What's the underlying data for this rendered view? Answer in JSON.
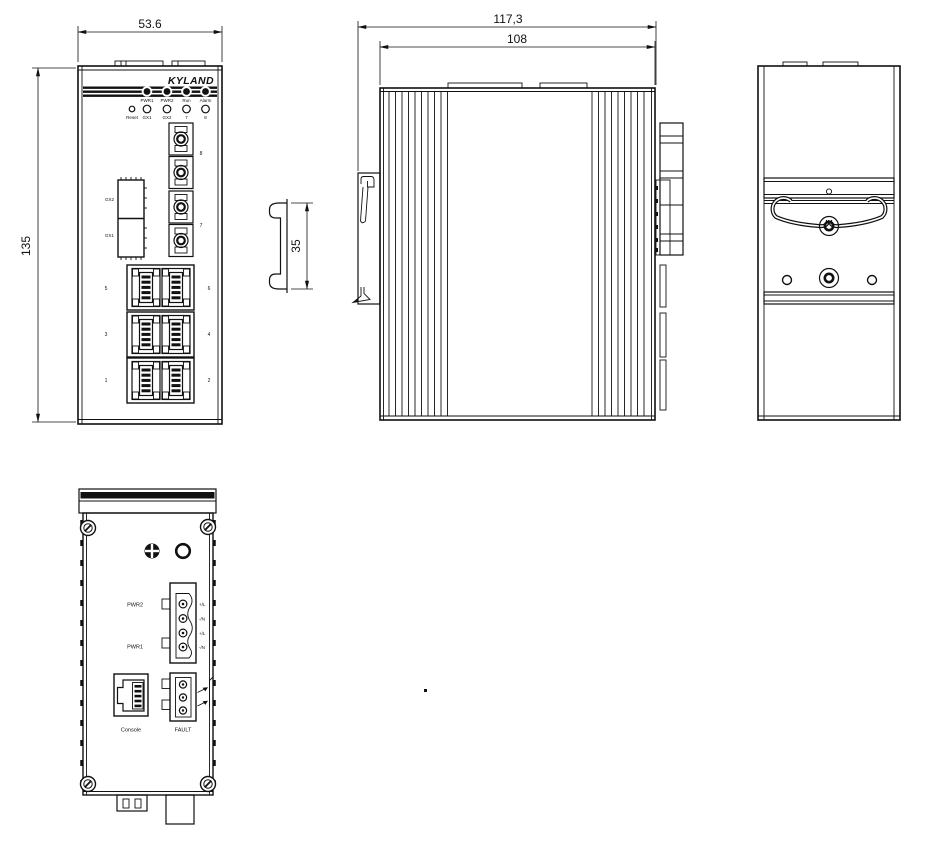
{
  "brand_logo": "KYLAND",
  "dimensions": {
    "front_width": "53.6",
    "front_height": "135",
    "depth_total": "117,3",
    "depth_body": "108",
    "din_rail": "35"
  },
  "front_view": {
    "status_leds": [
      "PWR1",
      "PWR2",
      "Run",
      "Alarm"
    ],
    "reset_label": "Reset",
    "port_leds": [
      "GX1",
      "GX2",
      "7",
      "8"
    ],
    "sfp_slot_top": "GX2",
    "sfp_slot_bottom": "GX1",
    "fiber_port_top": "8",
    "fiber_port_bottom": "7",
    "rj45_left": [
      "5",
      "3",
      "1"
    ],
    "rj45_right": [
      "6",
      "4",
      "2"
    ]
  },
  "bottom_view": {
    "power2_label": "PWR2",
    "power1_label": "PWR1",
    "terminal_pins": [
      "+/L",
      "-/N",
      "+/L",
      "-/N"
    ],
    "console_label": "Console",
    "fault_label": "FAULT"
  },
  "colors": {
    "line": "#111111",
    "background": "#ffffff"
  }
}
